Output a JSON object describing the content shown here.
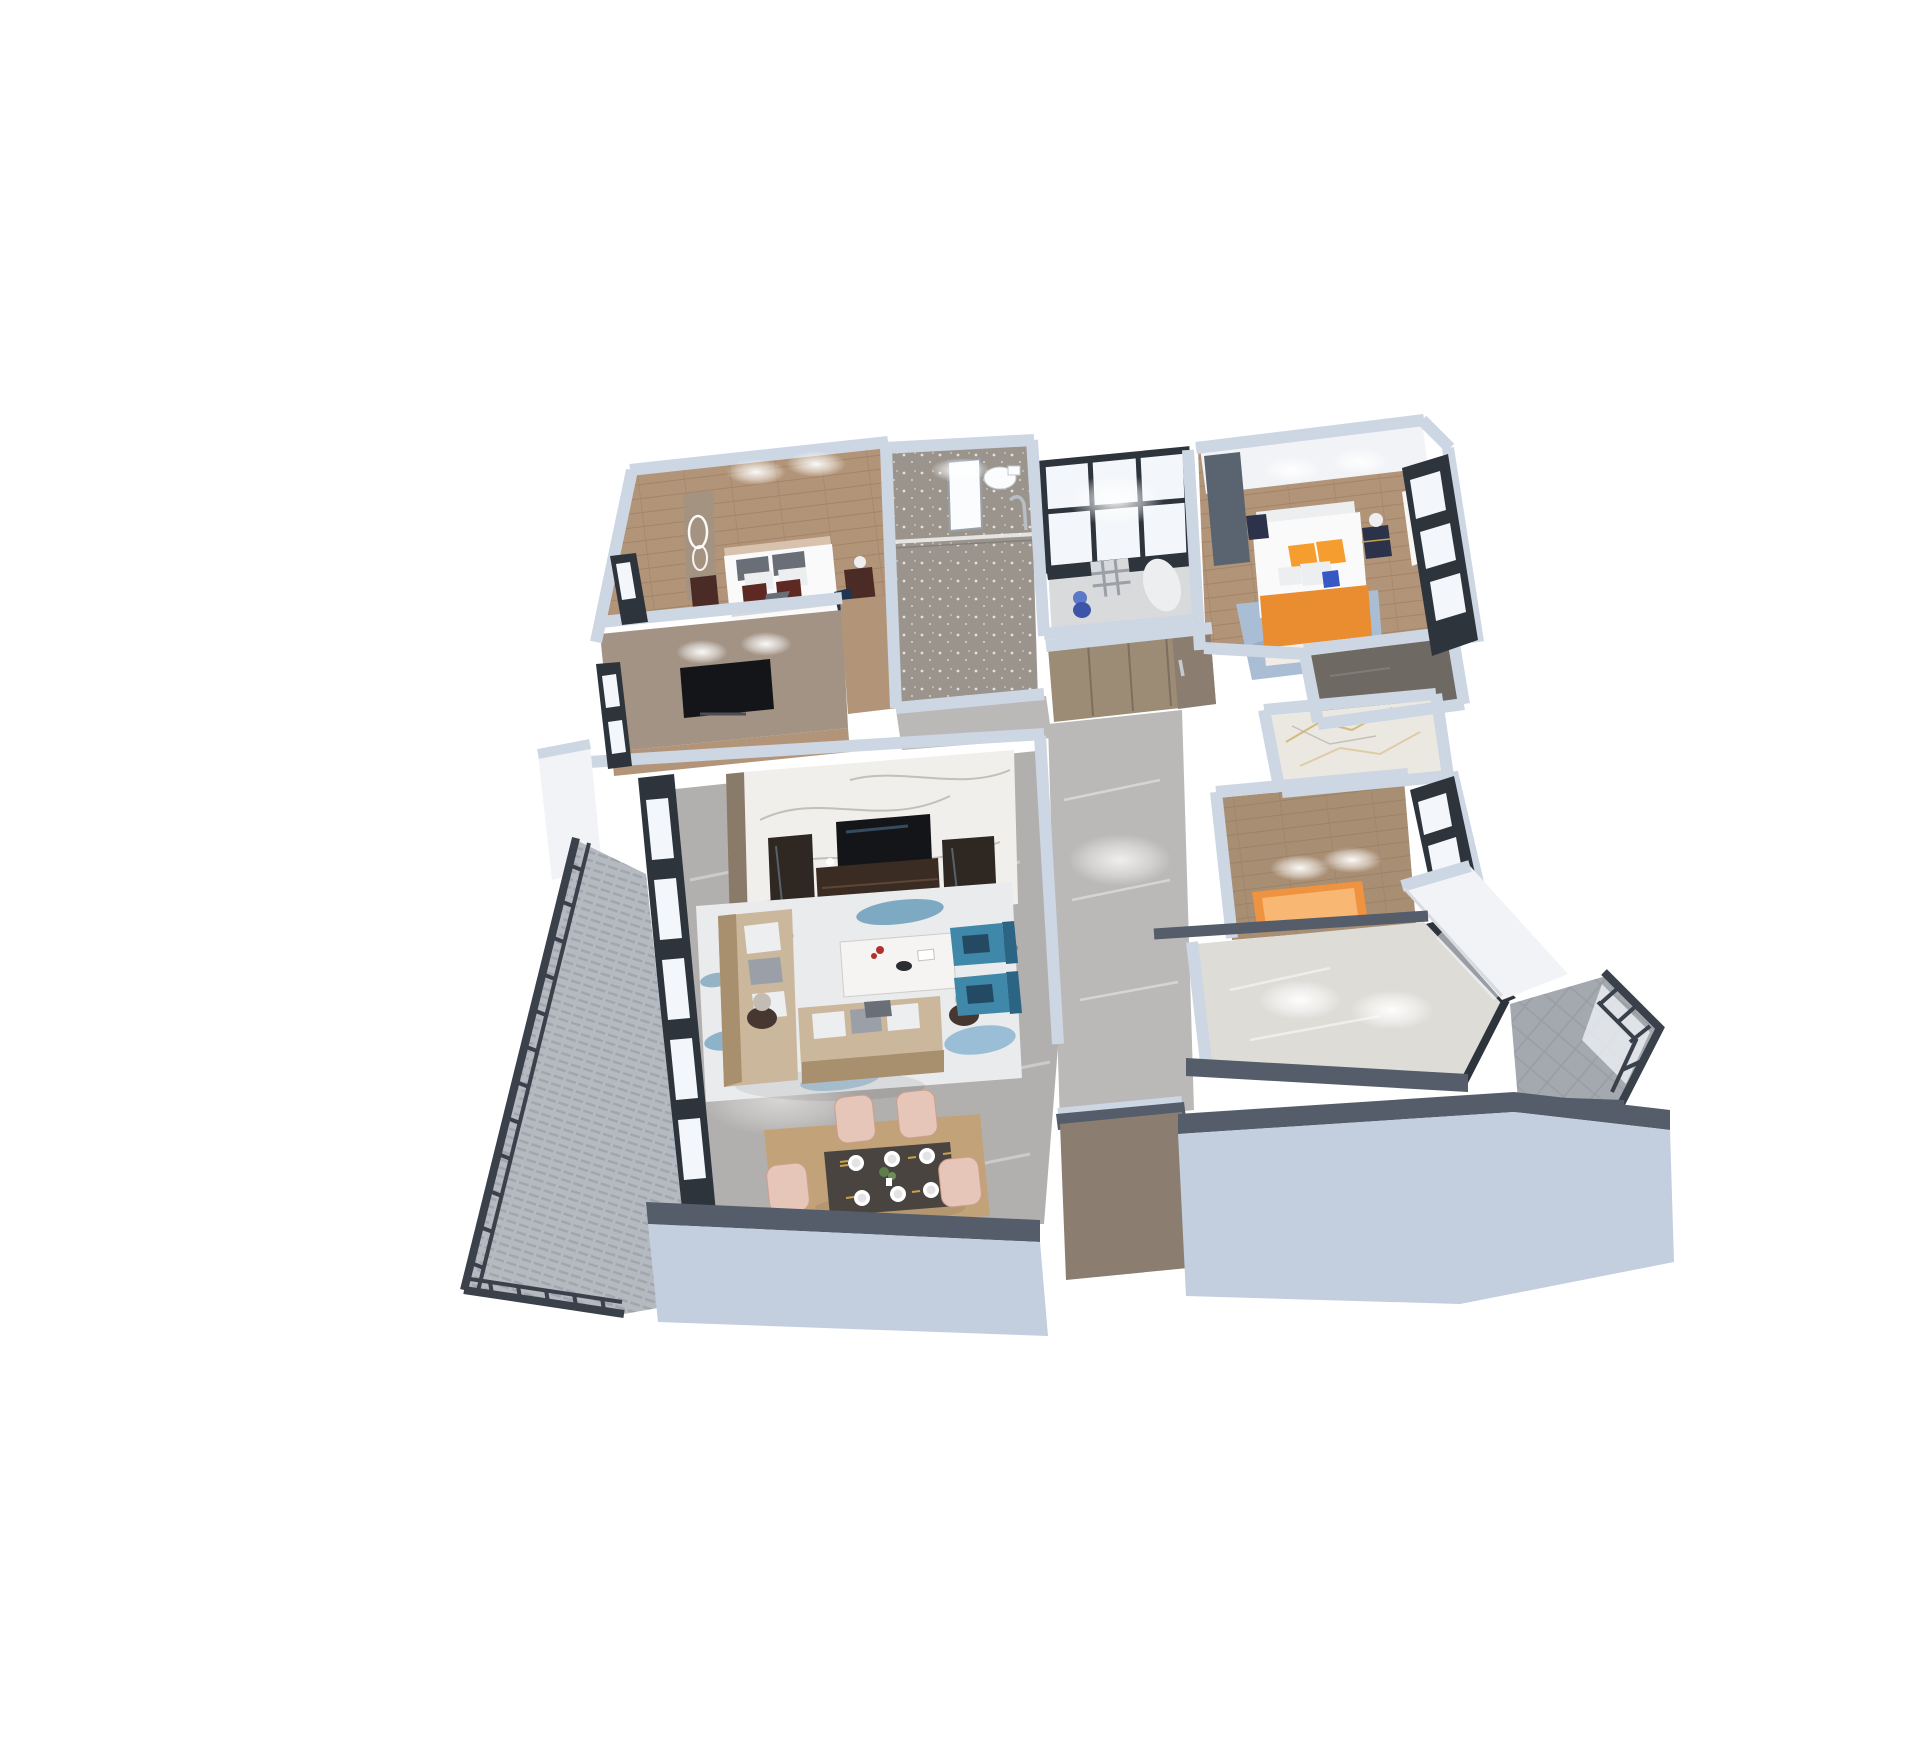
{
  "meta": {
    "description": "Photorealistic 3D axonometric floor-plan render of a three-bedroom apartment viewed from above on a plain white background",
    "background": "#ffffff"
  },
  "palette": {
    "bg": "#ffffff",
    "wallCap": "#cdd6e3",
    "wallCapEdge": "#b3bfd0",
    "wallFace": "#c3cedf",
    "wallDark": "#545d69",
    "wallWhite": "#f2f3f6",
    "wallTan": "#a29384",
    "wallBrown": "#8b7d70",
    "frame": "#2e343c",
    "glass": "#f3f6fa",
    "rail": "#3a414b",
    "woodMaster": "#b29478",
    "woodDining": "#c2a379",
    "woodStudy": "#a88e73",
    "floorBath": "#9a948d",
    "floorCloset": "#6f6963",
    "floorKid": "#d9dadc",
    "marbleLiving": "#b2b0ae",
    "marbleHall": "#bbb9b7",
    "marbleKitchen": "#dedcd7",
    "marbleWhiteRoom": "#ebe8e2",
    "marbleTVWall": "#f0efec",
    "veinGray": "#b5b0a8",
    "veinGold": "#c9a24a",
    "tileBalcony": "#a4a9b0",
    "carpet": "#b5b9c0",
    "carpetDash": "#989ea6",
    "tvBlack": "#141519",
    "walnut": "#3b2c23",
    "walnutLight": "#5d4636",
    "cabinetDark": "#2e2722",
    "sofa": "#cbb79c",
    "sofaDark": "#a8906f",
    "cushionWhite": "#eceef0",
    "cushionGray": "#9ba0a8",
    "pillowDarkGray": "#696e77",
    "maroon": "#5e2823",
    "navyThrow": "#1f3550",
    "bedWhite": "#fafafb",
    "headboardTan": "#d9c2ad",
    "armBlue": "#3f88a9",
    "armBlueDark": "#2c6483",
    "navyPillow": "#244a63",
    "rugBase": "#e9ebed",
    "rugBlue1": "#8db6d2",
    "rugBlue2": "#4f8db0",
    "rugBlue3": "#2e6f94",
    "tableWhite": "#f5f4f2",
    "lampShade": "#c2bcb4",
    "lampBase": "#463831",
    "orangePillow": "#f59d2e",
    "orangeBlanket": "#ea8c30",
    "sheet": "#f2ece4",
    "rugBed2": "#a9bdd5",
    "nightRed": "#4b2b25",
    "nightNavy": "#2b3249",
    "gold": "#c9a24a",
    "chairPink": "#e7c6ba",
    "chairPinkDark": "#cf9d8c",
    "benchOrange": "#ef9340",
    "benchOrangeLight": "#f8b773",
    "entryWood": "#9c8b75",
    "entryWoodDark": "#7d6f5d",
    "toiletWhite": "#fbfcfd"
  },
  "rooms": [
    {
      "id": "master-bedroom",
      "label": "Master bedroom",
      "floor": "wood",
      "furniture": [
        "double-bed",
        "gray-pillows",
        "maroon-pillows",
        "nightstands",
        "ring-light-sculpture",
        "wall-tv"
      ]
    },
    {
      "id": "bathroom",
      "label": "Bathroom",
      "floor": "gray-stone",
      "furniture": [
        "toilet",
        "shower",
        "glass-partition",
        "white-panel"
      ]
    },
    {
      "id": "kids-room",
      "label": "Kids room",
      "floor": "light-gray",
      "furniture": [
        "window-wall",
        "blue-toy",
        "checkered-mat",
        "white-bolster"
      ]
    },
    {
      "id": "bedroom-2",
      "label": "Second bedroom",
      "floor": "wood",
      "furniture": [
        "double-bed",
        "orange-pillows",
        "orange-blanket",
        "nightstands",
        "blue-rug",
        "window-wall",
        "curtain"
      ]
    },
    {
      "id": "walk-in-closet",
      "label": "Walk-in closet",
      "floor": "dark-gray"
    },
    {
      "id": "marble-bathroom",
      "label": "Second bathroom",
      "floor": "white-gold-marble"
    },
    {
      "id": "study",
      "label": "Study",
      "floor": "wood",
      "furniture": [
        "orange-daybed",
        "window-wall"
      ]
    },
    {
      "id": "kitchen",
      "label": "Kitchen",
      "floor": "white-marble",
      "furniture": [
        "glass-door"
      ]
    },
    {
      "id": "hallway",
      "label": "Hallway",
      "floor": "gray-marble"
    },
    {
      "id": "entry",
      "label": "Entry",
      "floor": "gray-marble",
      "furniture": [
        "wardrobe-cabinets",
        "entry-door"
      ]
    },
    {
      "id": "living-room",
      "label": "Living room",
      "floor": "gray-marble",
      "furniture": [
        "marble-tv-wall",
        "flat-tv",
        "tv-console",
        "side-cabinets",
        "loveseat",
        "sofa",
        "coffee-table",
        "blue-armchairs",
        "drum-lamps",
        "abstract-blue-rug"
      ]
    },
    {
      "id": "dining-area",
      "label": "Dining area",
      "floor": "wood",
      "furniture": [
        "dark-dining-table",
        "place-settings",
        "plant-centerpiece",
        "pink-chairs"
      ]
    },
    {
      "id": "balcony-west",
      "label": "West balcony",
      "floor": "carpet-tiles",
      "furniture": [
        "metal-railing"
      ]
    },
    {
      "id": "balcony-southeast",
      "label": "South-east balcony",
      "floor": "gray-tiles",
      "furniture": [
        "metal-glass-railing"
      ]
    }
  ]
}
